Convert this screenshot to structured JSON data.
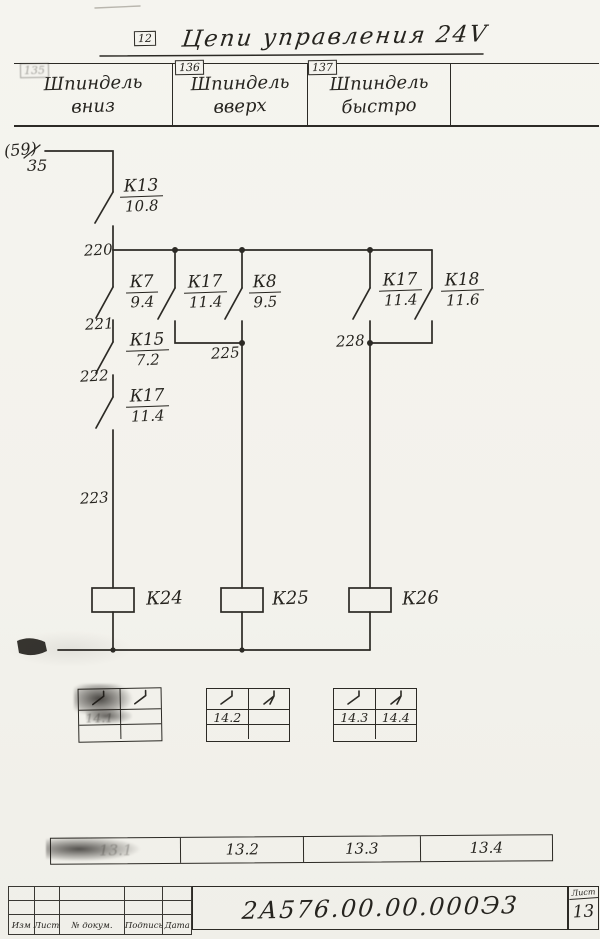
{
  "page": {
    "zone_tag": "12",
    "title": "Цепи управления 24V"
  },
  "header": {
    "columns": [
      {
        "tag": "135",
        "line1": "Шпиндель",
        "line2": "вниз"
      },
      {
        "tag": "136",
        "line1": "Шпиндель",
        "line2": "вверх"
      },
      {
        "tag": "137",
        "line1": "Шпиндель",
        "line2": "быстро"
      },
      {
        "tag": "",
        "line1": "",
        "line2": ""
      }
    ]
  },
  "source": {
    "sheet_ref": "(59)",
    "wire": "35"
  },
  "contacts": {
    "k13": {
      "name": "К13",
      "ref": "10.8"
    },
    "k7": {
      "name": "К7",
      "ref": "9.4"
    },
    "k17a": {
      "name": "К17",
      "ref": "11.4"
    },
    "k8": {
      "name": "К8",
      "ref": "9.5"
    },
    "k17b": {
      "name": "К17",
      "ref": "11.4"
    },
    "k18": {
      "name": "К18",
      "ref": "11.6"
    },
    "k15": {
      "name": "К15",
      "ref": "7.2"
    },
    "k17c": {
      "name": "К17",
      "ref": "11.4"
    }
  },
  "wires": {
    "w220": "220",
    "w221": "221",
    "w222": "222",
    "w223": "223",
    "w225": "225",
    "w228": "228"
  },
  "coils": {
    "k24": "К24",
    "k25": "К25",
    "k26": "К26"
  },
  "contact_tables": [
    {
      "row2": [
        "14.1",
        ""
      ]
    },
    {
      "row2": [
        "14.2",
        ""
      ]
    },
    {
      "row2": [
        "14.3",
        "14.4"
      ]
    }
  ],
  "bottom_strip": {
    "cells": [
      "13.1",
      "13.2",
      "13.3",
      "13.4"
    ]
  },
  "title_block": {
    "columns": [
      "Изм",
      "Лист",
      "№ докум.",
      "Подпись",
      "Дата"
    ],
    "doc_number": "2А576.00.00.000Э3",
    "sheet_label": "Лист",
    "sheet_number": "13"
  },
  "colors": {
    "ink": "#2c2a25",
    "paper": "#f4f3ee"
  }
}
